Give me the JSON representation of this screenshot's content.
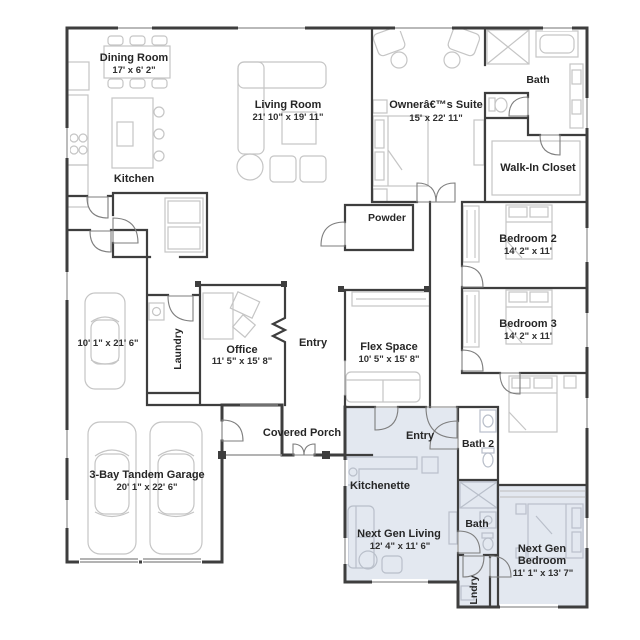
{
  "plan": {
    "title": "Floor Plan",
    "colors": {
      "wall": "#3e3e3e",
      "furniture": "#c5c5c5",
      "next_gen_shade": "#e3e8f0",
      "text": "#262626"
    },
    "rooms": {
      "dining": {
        "name": "Dining Room",
        "dims": "17' x 6' 2\""
      },
      "living": {
        "name": "Living Room",
        "dims": "21' 10\" x 19' 11\""
      },
      "kitchen": {
        "name": "Kitchen"
      },
      "owners_suite": {
        "name": "Ownerâ€™s Suite",
        "dims": "15' x 22' 11\""
      },
      "owners_bath": {
        "name": "Bath"
      },
      "walk_in_closet": {
        "name": "Walk-In Closet"
      },
      "powder": {
        "name": "Powder"
      },
      "bedroom2": {
        "name": "Bedroom 2",
        "dims": "14' 2\" x 11'"
      },
      "bedroom3": {
        "name": "Bedroom 3",
        "dims": "14' 2\" x 11'"
      },
      "bedroom4": {
        "name": "Bedroom 4",
        "dims": "11' 2\" x 12' 3\""
      },
      "laundry": {
        "name": "Laundry"
      },
      "office": {
        "name": "Office",
        "dims": "11' 5\" x 15' 8\""
      },
      "entry": {
        "name": "Entry"
      },
      "flex": {
        "name": "Flex Space",
        "dims": "10' 5\" x 15' 8\""
      },
      "covered_porch": {
        "name": "Covered Porch"
      },
      "garage_bay": {
        "dims": "10' 1\" x 21' 6\""
      },
      "garage": {
        "name": "3-Bay Tandem Garage",
        "dims": "20' 1\" x 22' 6\""
      },
      "ng_entry": {
        "name": "Entry"
      },
      "bath2": {
        "name": "Bath 2"
      },
      "kitchenette": {
        "name": "Kitchenette"
      },
      "ng_living": {
        "name": "Next Gen Living",
        "dims": "12' 4\" x 11' 6\""
      },
      "ng_bath": {
        "name": "Bath"
      },
      "ng_bedroom": {
        "name1": "Next Gen",
        "name2": "Bedroom",
        "dims": "11' 1\" x 13' 7\""
      },
      "lndry": {
        "name": "Lndry"
      }
    }
  }
}
